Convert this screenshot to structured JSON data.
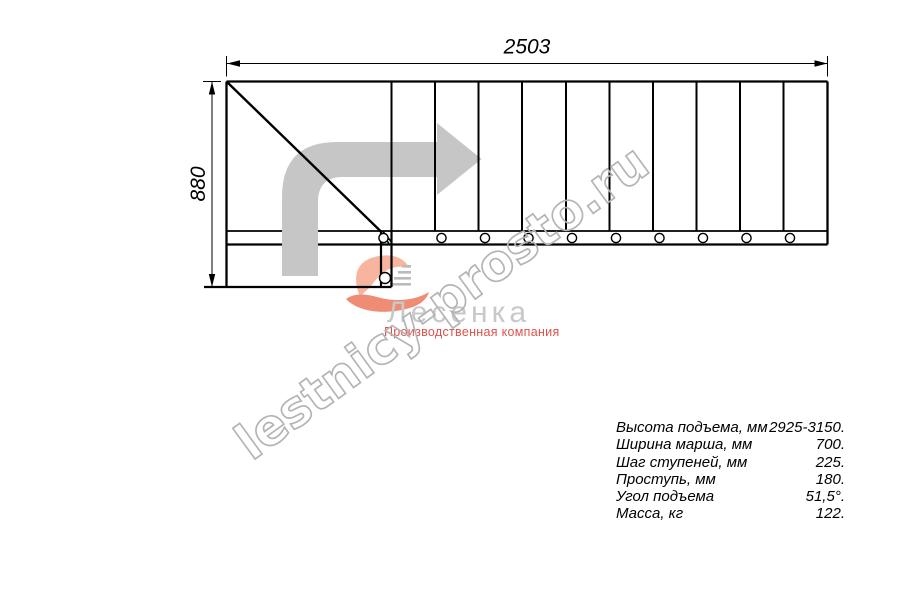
{
  "drawing": {
    "width_dim": "2503",
    "height_dim": "880"
  },
  "watermark": "lestnicy-prosto.ru",
  "logo": {
    "brand": "Лесенка",
    "tagline": "Производственная компания"
  },
  "specs": [
    {
      "label": "Высота подъема, мм",
      "value": "2925-3150."
    },
    {
      "label": "Ширина марша, мм",
      "value": "700."
    },
    {
      "label": "Шаг ступеней, мм",
      "value": "225."
    },
    {
      "label": "Проступь, мм",
      "value": "180."
    },
    {
      "label": "Угол подъема",
      "value": "51,5°."
    },
    {
      "label": "Масса, кг",
      "value": "122."
    }
  ],
  "icons": {
    "direction_arrow": "turn-right-arrow",
    "logo_flame": "flame-swoosh",
    "logo_steps": "stair-steps"
  },
  "colors": {
    "line": "#000000",
    "arrow_fill": "#c6c6c6",
    "watermark_stroke": "#b4b4b4",
    "brand_gray": "#c8c8c8",
    "brand_red": "#e2504a",
    "flame_light": "#f7b49e",
    "flame_dark": "#ef8d74"
  }
}
